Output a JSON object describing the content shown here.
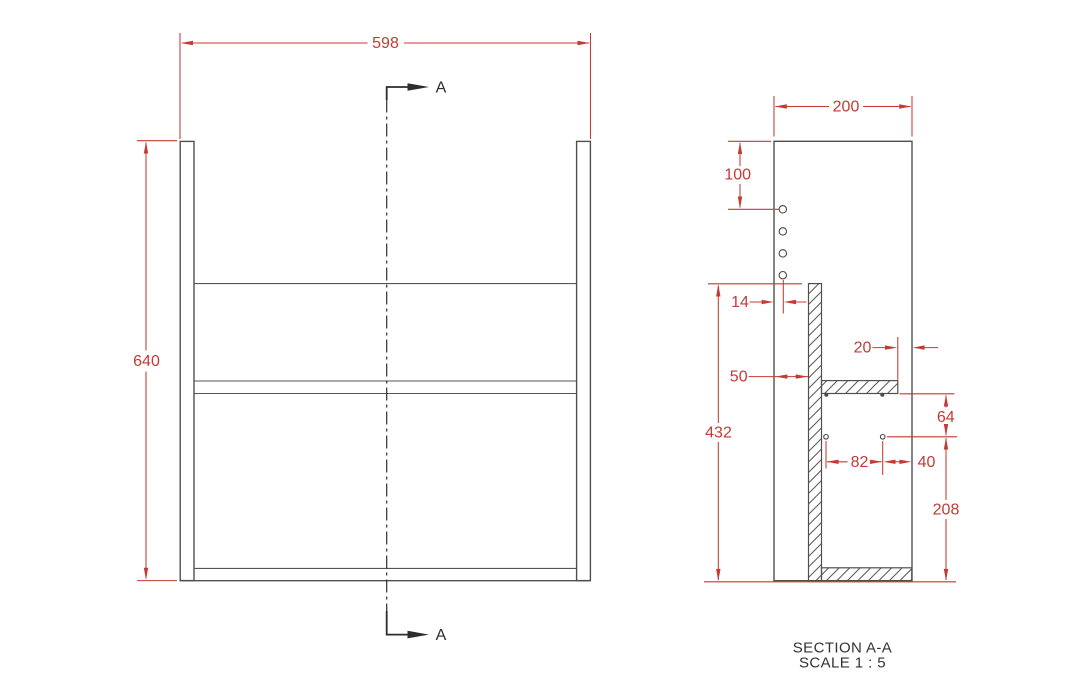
{
  "drawing": {
    "type": "furniture technical drawing",
    "units": "mm",
    "front_view": {
      "width_dim": "598",
      "height_dim": "640",
      "section_marker": "A"
    },
    "section_view": {
      "depth_dim": "200",
      "top_to_first_hole_dim": "100",
      "hole_edge_inset_dim": "14",
      "back_panel_inset_dim": "50",
      "shelf_front_reveal_dim": "20",
      "back_panel_height_dim": "432",
      "shelf_to_hole_dim": "64",
      "hole_spacing_dim": "82",
      "hole_to_front_dim": "40",
      "hole_to_bottom_dim": "208",
      "caption_title": "SECTION A-A",
      "caption_scale": "SCALE 1 : 5"
    },
    "colors": {
      "dimension_red": "#c43a34",
      "line_dark": "#4f4f4f",
      "marker_black": "#2d2d2d",
      "background": "#ffffff"
    }
  }
}
